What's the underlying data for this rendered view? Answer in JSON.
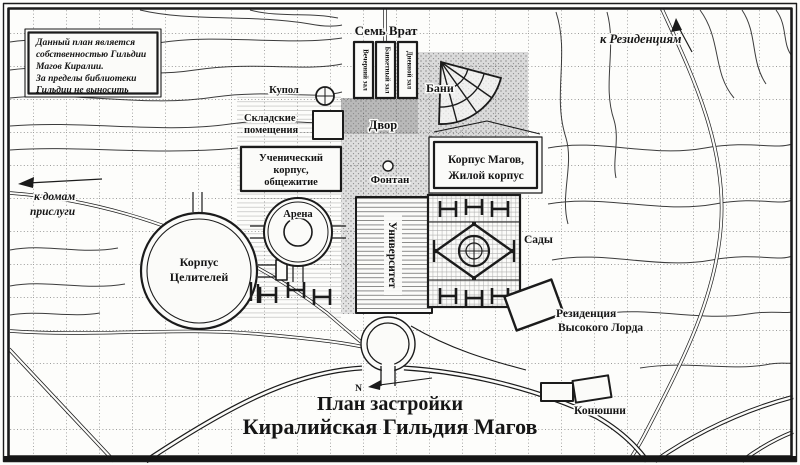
{
  "map_title": {
    "line1": "План застройки",
    "line2": "Киралийская Гильдия Магов"
  },
  "notice_box": {
    "lines": [
      "Данный план является",
      "собственностью Гильдии",
      "Магов Киралии.",
      "За пределы библиотеки",
      "Гильдии не выносить"
    ]
  },
  "compass": {
    "north": "N"
  },
  "places": {
    "seven_gates": "Семь Врат",
    "evening_hall": "Вечерний зал",
    "banquet_hall": "Банкетный зал",
    "day_hall": "Дневной зал",
    "baths": "Бани",
    "dome": "Купол",
    "storage_line1": "Складские",
    "storage_line2": "помещения",
    "courtyard": "Двор",
    "fountain": "Фонтан",
    "magicians_line1": "Корпус Магов,",
    "magicians_line2": "Жилой корпус",
    "novices_line1": "Ученический",
    "novices_line2": "корпус,",
    "novices_line3": "общежитие",
    "arena": "Арена",
    "university": "Университет",
    "gardens": "Сады",
    "healers_line1": "Корпус",
    "healers_line2": "Целителей",
    "residence_line1": "Резиденция",
    "residence_line2": "Высокого Лорда",
    "stables": "Конюшни"
  },
  "directions": {
    "to_residences": "к Резиденциям",
    "to_servants_line1": "к домам",
    "to_servants_line2": "прислуги"
  },
  "colors": {
    "ink": "#1b1b1b",
    "paper": "#fbfbf9",
    "shade": "#c6c6c6"
  }
}
